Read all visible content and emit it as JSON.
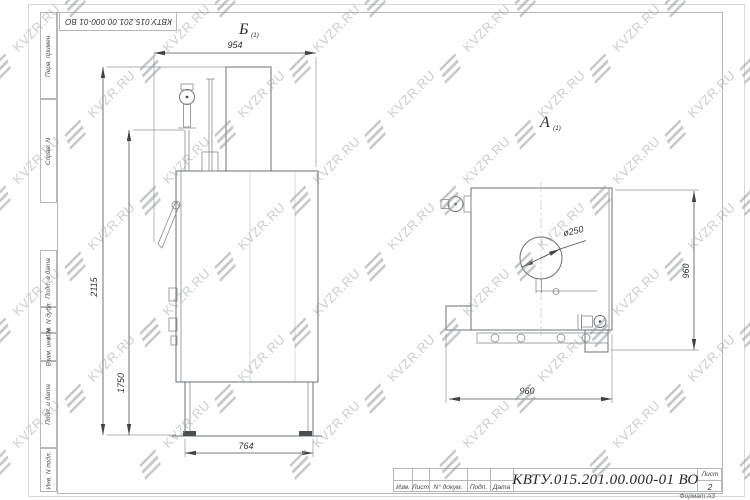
{
  "watermark": {
    "text": "KVZR.RU"
  },
  "frame": {
    "top_stamp": "КВТУ.015.201.00.000-01 ВО",
    "side_strip": [
      "Перв. примен.",
      "Справ. N",
      "Подп. и дата",
      "Инв. N дубл.",
      "Взам. инв. N",
      "Подп. и дата",
      "Инв. N подл."
    ]
  },
  "views": {
    "side": {
      "label": "Б",
      "label_sub": "(1)",
      "width": "954",
      "height_total": "2115",
      "height_body": "1750",
      "base_width": "764"
    },
    "front": {
      "label": "А",
      "label_sub": "(1)",
      "width": "960",
      "height": "960",
      "flue_diameter": "ø250"
    }
  },
  "titleblock": {
    "designation": "КВТУ.015.201.00.000-01 ВО",
    "columns": [
      "Изм.",
      "Лист",
      "N° докум.",
      "Подп.",
      "Дата"
    ],
    "sheet_label": "Лист",
    "sheet_number": "2",
    "format_label": "Формат А3"
  }
}
